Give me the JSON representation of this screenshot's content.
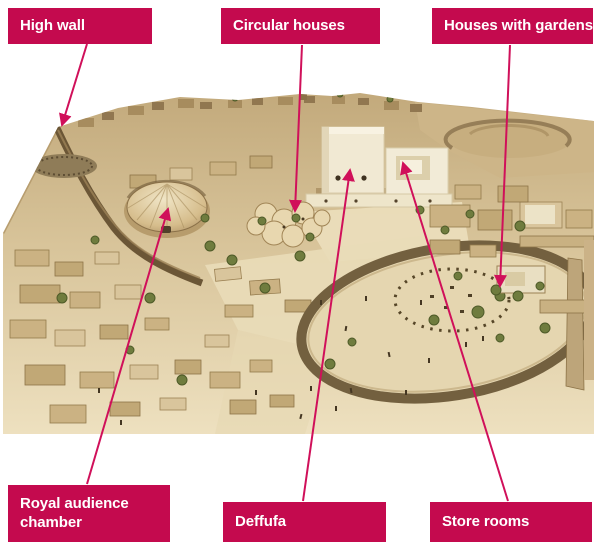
{
  "diagram": {
    "labels": [
      {
        "id": "high-wall",
        "text": "High wall"
      },
      {
        "id": "circular-houses",
        "text": "Circular houses"
      },
      {
        "id": "houses-with-gardens",
        "text": "Houses with gardens"
      },
      {
        "id": "royal-audience-chamber",
        "text": "Royal audience chamber"
      },
      {
        "id": "deffufa",
        "text": "Deffufa"
      },
      {
        "id": "store-rooms",
        "text": "Store rooms"
      }
    ],
    "icons": {
      "arrowhead": "filled triangle pointer on each callout line"
    },
    "colors": {
      "label-bg": "#c40a4e",
      "label-text": "#ffffff",
      "connector": "#d0105a",
      "page-bg": "#ffffff",
      "model-sand-dark": "#c2a97b",
      "model-sand-light": "#eee1c0",
      "model-wall-dark": "#6b5636",
      "model-building-cream": "#f1e9d3",
      "model-tree-green": "#6f7c3e"
    }
  }
}
